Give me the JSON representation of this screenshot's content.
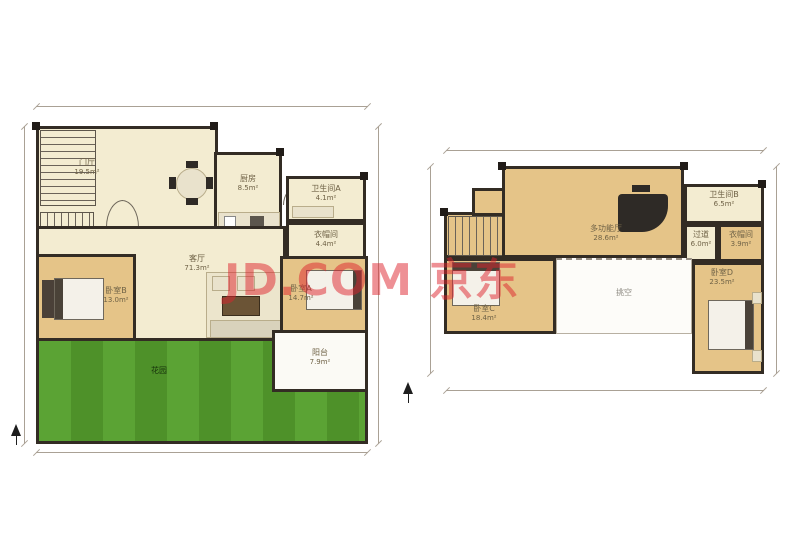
{
  "watermark": {
    "text": "JD.COM 京东",
    "color_hex": "#de222c"
  },
  "palette": {
    "wall": "#332c24",
    "room_cream": "#f3ecd1",
    "room_wood": "#e5c488",
    "garden_green": "#57a02f",
    "void_white": "#fdfcf9",
    "dimension_gray": "#aaa195"
  },
  "floor1": {
    "rooms": [
      {
        "name": "门厅",
        "area": "19.5m²"
      },
      {
        "name": "厨房",
        "area": "8.5m²"
      },
      {
        "name": "卫生间A",
        "area": "4.1m²"
      },
      {
        "name": "衣帽间",
        "area": "4.4m²"
      },
      {
        "name": "客厅",
        "area": "71.3m²"
      },
      {
        "name": "卧室B",
        "area": "13.0m²"
      },
      {
        "name": "卧室A",
        "area": "14.7m²"
      },
      {
        "name": "阳台",
        "area": "7.9m²"
      },
      {
        "name": "花园",
        "area": ""
      }
    ]
  },
  "floor2": {
    "rooms": [
      {
        "name": "多功能厅",
        "area": "28.6m²"
      },
      {
        "name": "卫生间B",
        "area": "6.5m²"
      },
      {
        "name": "过道",
        "area": "6.0m²"
      },
      {
        "name": "衣帽间",
        "area": "3.9m²"
      },
      {
        "name": "卧室C",
        "area": "18.4m²"
      },
      {
        "name": "挑空",
        "area": ""
      },
      {
        "name": "卧室D",
        "area": "23.5m²"
      }
    ]
  }
}
